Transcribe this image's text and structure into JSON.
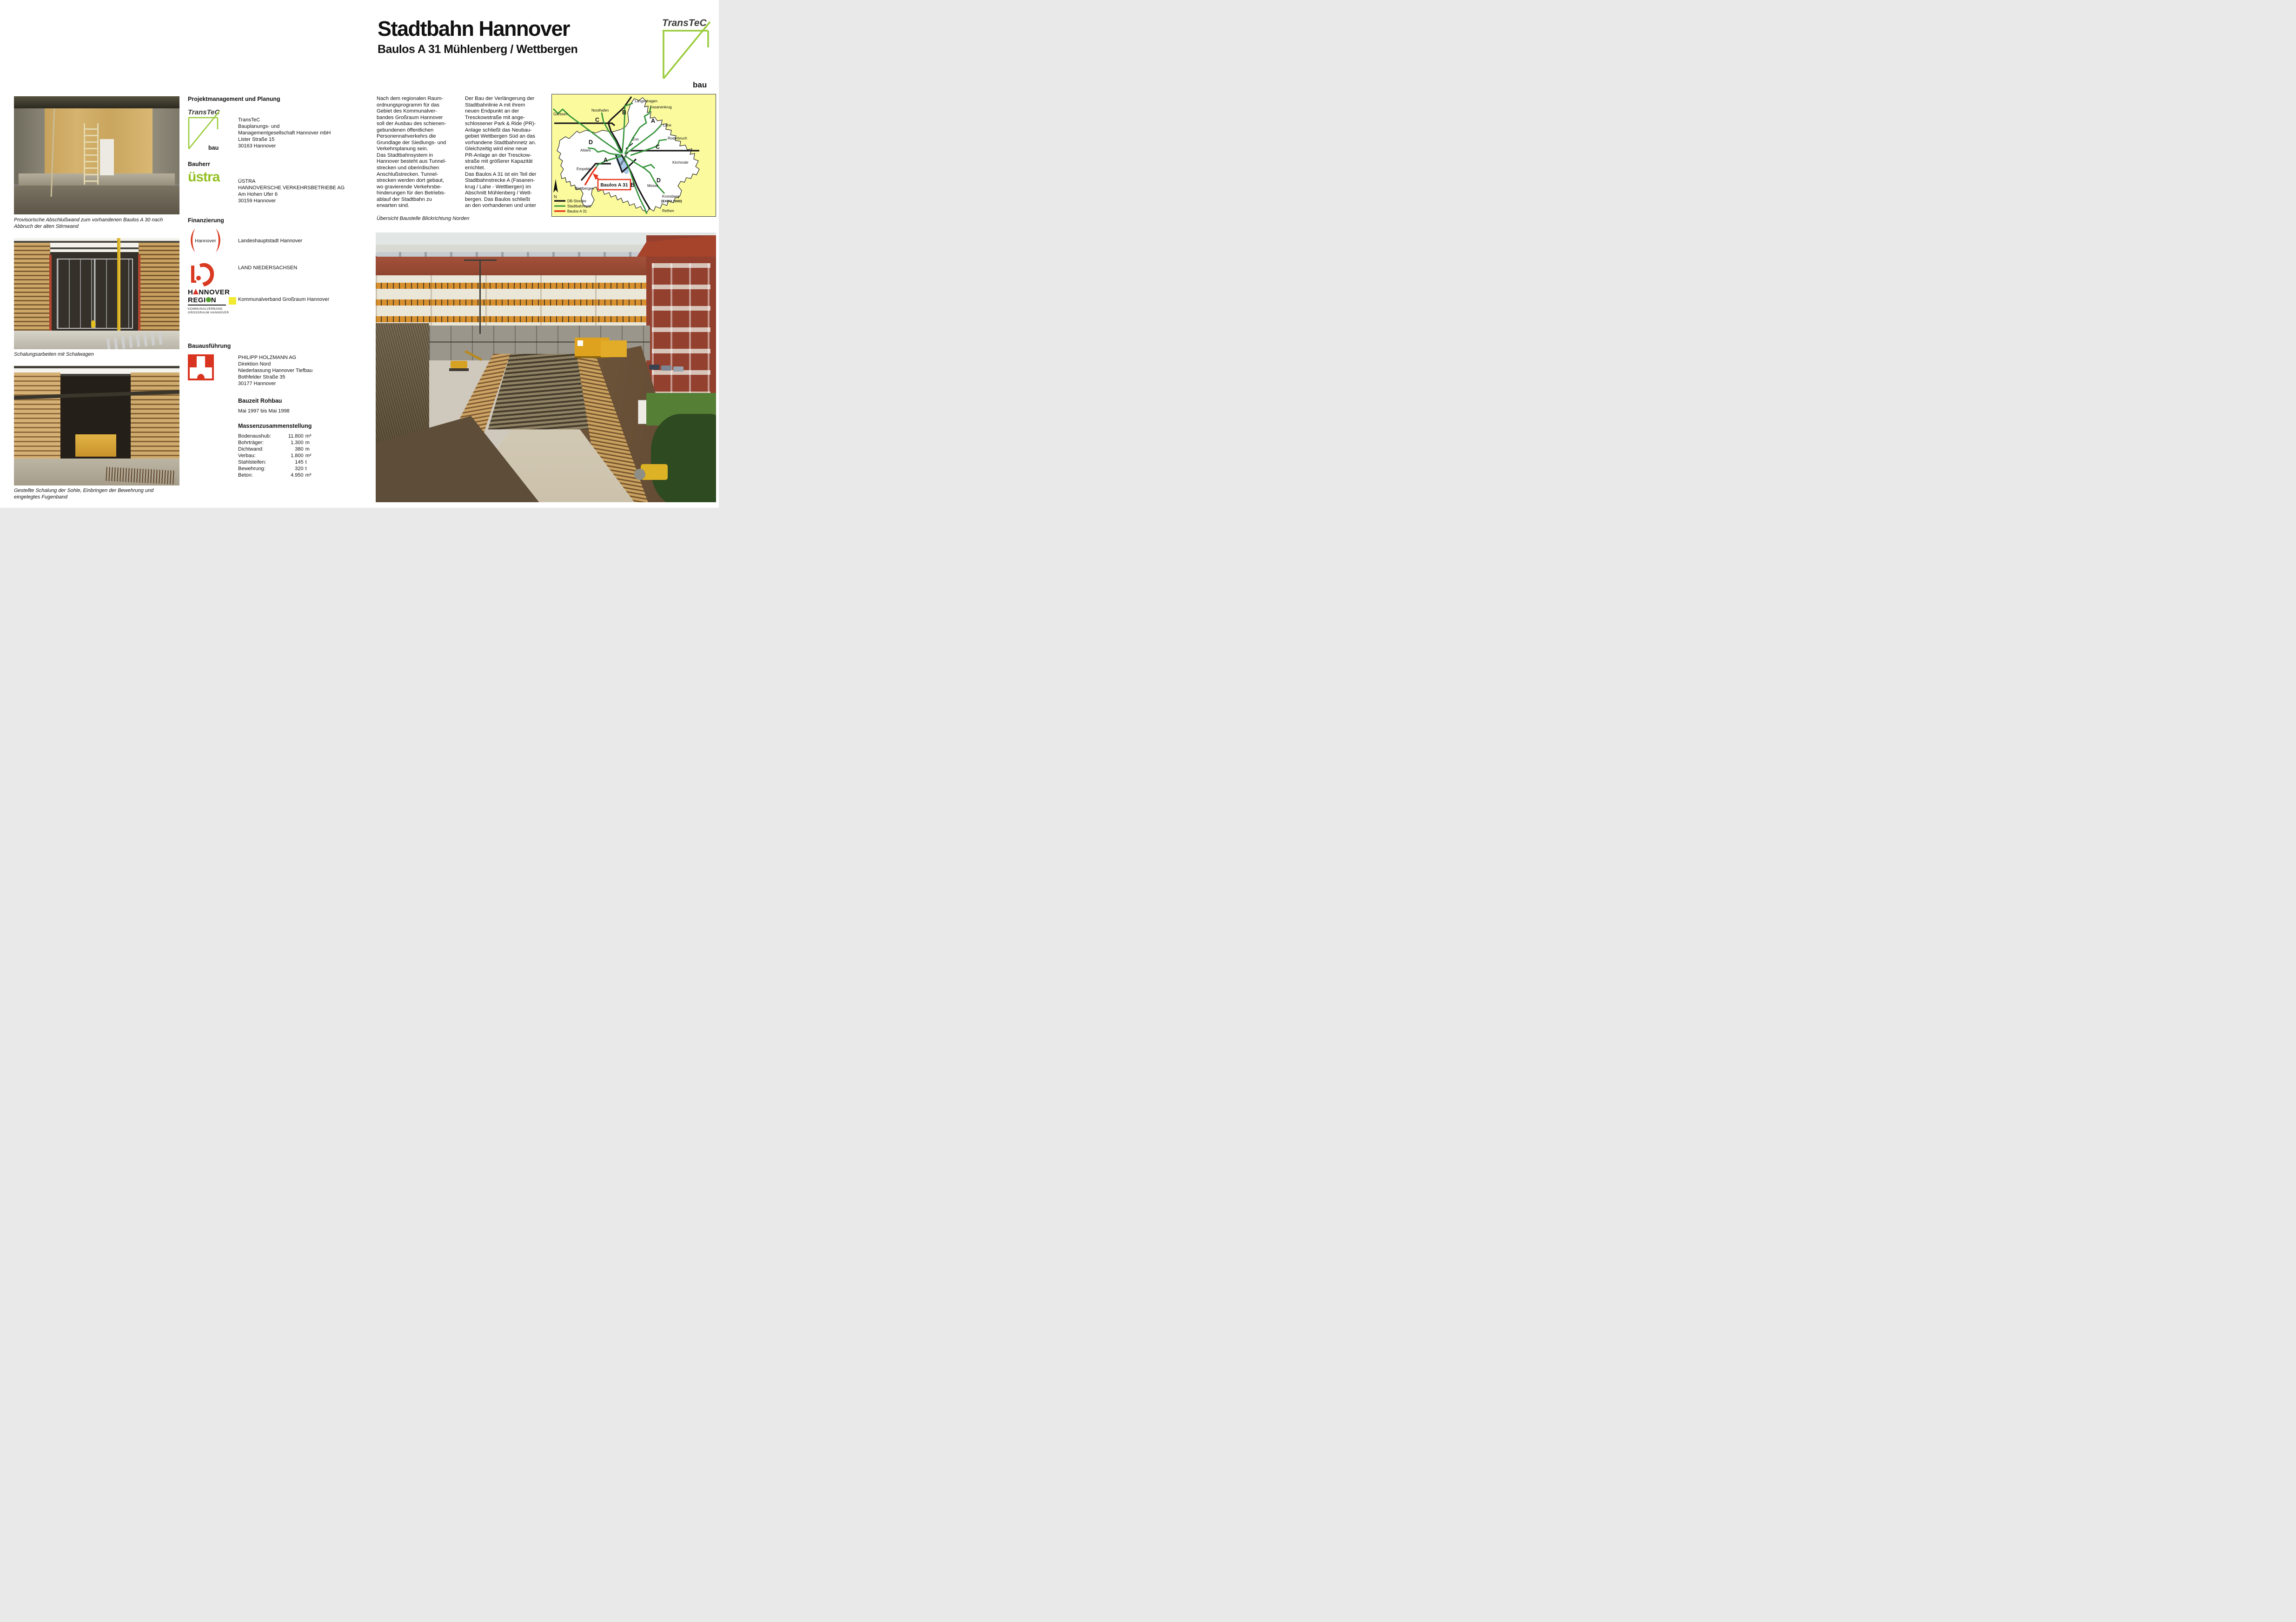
{
  "header": {
    "title_line1": "Stadtbahn Hannover",
    "title_line2": "Baulos A 31 Mühlenberg / Wettbergen",
    "logo": {
      "wordmark": "TransTeC",
      "sub": "bau",
      "green": "#9acc3c"
    }
  },
  "left": {
    "captions": {
      "photo1": "Provisorische Abschlußwand zum vorhandenen Baulos A 30 nach\nAbbruch der alten Stirnwand",
      "photo2": "Schalungsarbeiten mit Schalwagen",
      "photo3": "Gestellte Schalung der Sohle, Einbringen der Bewehrung und\neingelegtes Fugenband"
    }
  },
  "info": {
    "projekt": {
      "heading": "Projektmanagement und Planung",
      "logo_wordmark": "TransTeC",
      "logo_sub": "bau",
      "address": "TransTeC\nBauplanungs- und\nManagementgesellschaft Hannover mbH\nLister Straße 15\n30163 Hannover"
    },
    "bauherr": {
      "heading": "Bauherr",
      "logo_wordmark": "üstra",
      "address": "ÜSTRA\nHANNOVERSCHE VERKEHRSBETRIEBE AG\nAm Hohen Ufer 6\n30159 Hannover"
    },
    "finanzierung": {
      "heading": "Finanzierung",
      "hannover": {
        "logo_text": "Hannover",
        "label": "Landeshauptstadt Hannover"
      },
      "niedersachsen": {
        "label": "LAND NIEDERSACHSEN"
      },
      "region": {
        "logo_l1a": "H",
        "logo_l1b": "NNOVER",
        "logo_l2a": "REGI",
        "logo_l2b": "N",
        "logo_sub": "KOMMUNALVERBAND\nGROSSRAUM HANNOVER",
        "label": "Kommunalverband Großraum Hannover"
      }
    },
    "bauausfuehrung": {
      "heading": "Bauausführung",
      "address": "PHILIPP HOLZMANN AG\nDirektion Nord\nNiederlassung Hannover Tiefbau\nBothfelder Straße 35\n30177 Hannover"
    },
    "bauzeit": {
      "heading": "Bauzeit Rohbau",
      "value": "Mai 1997 bis Mai 1998"
    },
    "massen": {
      "heading": "Massenzusammenstellung",
      "rows": [
        {
          "label": "Bodenaushub:",
          "value": "11.800",
          "unit": "m³"
        },
        {
          "label": "Bohrträger:",
          "value": "1.300",
          "unit": "m"
        },
        {
          "label": "Dichtwand:",
          "value": "380",
          "unit": "m"
        },
        {
          "label": "Verbau:",
          "value": "1.800",
          "unit": "m²"
        },
        {
          "label": "Stahlsteifen:",
          "value": "145",
          "unit": "t"
        },
        {
          "label": "Bewehrung:",
          "value": "320",
          "unit": "t"
        },
        {
          "label": "Beton:",
          "value": "4.950",
          "unit": "m³"
        }
      ]
    }
  },
  "article": {
    "col1": "Nach dem regionalen Raum-\nordnungsprogramm für das\nGebiet des Kommunalver-\nbandes Großraum Hannover\nsoll der Ausbau des schienen-\ngebundenen öffentlichen\nPersonennahverkehrs die\nGrundlage der Siedlungs- und\nVerkehrsplanung sein.\nDas Stadtbahnsystem in\nHannover besteht aus Tunnel-\nstrecken und oberirdischen\nAnschlußstrecken. Tunnel-\nstrecken werden dort gebaut,\nwo gravierende Verkehrsbe-\nhinderungen für den Betriebs-\nablauf der Stadtbahn zu\nerwarten sind.",
    "col2": "Der Bau der Verlängerung der\nStadtbahnlinie A mit ihrem\nneuen Endpunkt an der\nTresckowstraße mit ange-\nschlossener Park & Ride (PR)-\nAnlage schließt das Neubau-\ngebiet Wettbergen Süd an das\nvorhandene Stadtbahnnetz an.\nGleichzeitig wird eine neue\nPR-Anlage an der Tresckow-\nstraße mit größerer Kapazität\nerrichtet.\nDas Baulos A 31 ist ein Teil der\nStadtbahnstrecke A (Fasanen-\nkrug / Lahe - Wettbergen) im\nAbschnitt Mühlenberg / Wett-\nbergen. Das Baulos schließt\nan den vorhandenen und unter",
    "map_caption": "Übersicht Baustelle Blickrichtung Norden"
  },
  "map": {
    "labels": {
      "garbsen": "Garbsen",
      "nordhafen": "Nordhafen",
      "langenhagen": "Langenhagen",
      "fasanenkrug": "Fasanenkrug",
      "b1": "B",
      "c1": "C",
      "a1": "A",
      "lahe": "Lahe",
      "d1": "D",
      "ahlem": "Ahlem",
      "zoo": "Zoo",
      "roderbruch": "Roderbruch",
      "c2": "C",
      "a2": "A",
      "empelde": "Empelde",
      "maschsee": "Maschsee",
      "kirchrode": "Kirchrode",
      "wettbergen": "Wettbergen",
      "b2": "B",
      "messe": "Messe",
      "d2": "D",
      "kronsberg": "Kronsberg",
      "expo": "(EXPO 2000)",
      "rethen": "Rethen",
      "north": "N"
    },
    "callout": "Baulos A 31",
    "legend": [
      {
        "label": "DB-Strecke",
        "color": "#1a1a1a"
      },
      {
        "label": "Stadtbahnnetz",
        "color": "#37953c"
      },
      {
        "label": "Baulos A 31",
        "color": "#e8391e"
      }
    ],
    "colors": {
      "background": "#fbfb9e",
      "city": "#ffffff",
      "lake": "#a9c7e8"
    }
  }
}
